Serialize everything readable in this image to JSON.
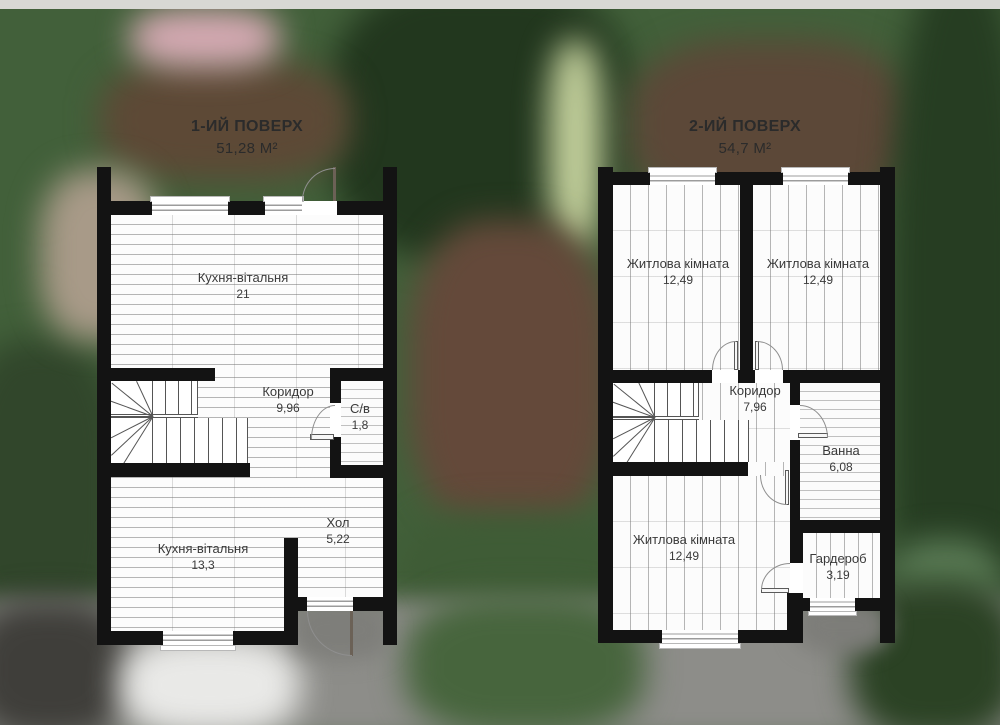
{
  "floor1": {
    "title": "1-ИЙ ПОВЕРХ",
    "area_total": "51,28 М²",
    "rooms": {
      "kitchen_top": {
        "name": "Кухня-вітальня",
        "area": "21"
      },
      "corridor": {
        "name": "Коридор",
        "area": "9,96"
      },
      "wc": {
        "name": "С/в",
        "area": "1,8"
      },
      "kitchen_bottom": {
        "name": "Кухня-вітальня",
        "area": "13,3"
      },
      "hall": {
        "name": "Хол",
        "area": "5,22"
      }
    }
  },
  "floor2": {
    "title": "2-ИЙ ПОВЕРХ",
    "area_total": "54,7 М²",
    "rooms": {
      "bedroom_top_left": {
        "name": "Житлова кімната",
        "area": "12,49"
      },
      "bedroom_top_right": {
        "name": "Житлова кімната",
        "area": "12,49"
      },
      "corridor": {
        "name": "Коридор",
        "area": "7,96"
      },
      "bath": {
        "name": "Ванна",
        "area": "6,08"
      },
      "bedroom_bottom": {
        "name": "Житлова кімната",
        "area": "12,49"
      },
      "wardrobe": {
        "name": "Гардероб",
        "area": "3,19"
      }
    }
  },
  "colors": {
    "wall": "#131313",
    "floor": "#fcfcfc",
    "label_text": "#3a3a3a",
    "background_green": "#42603a",
    "pavement_gray": "#8d8d89"
  }
}
